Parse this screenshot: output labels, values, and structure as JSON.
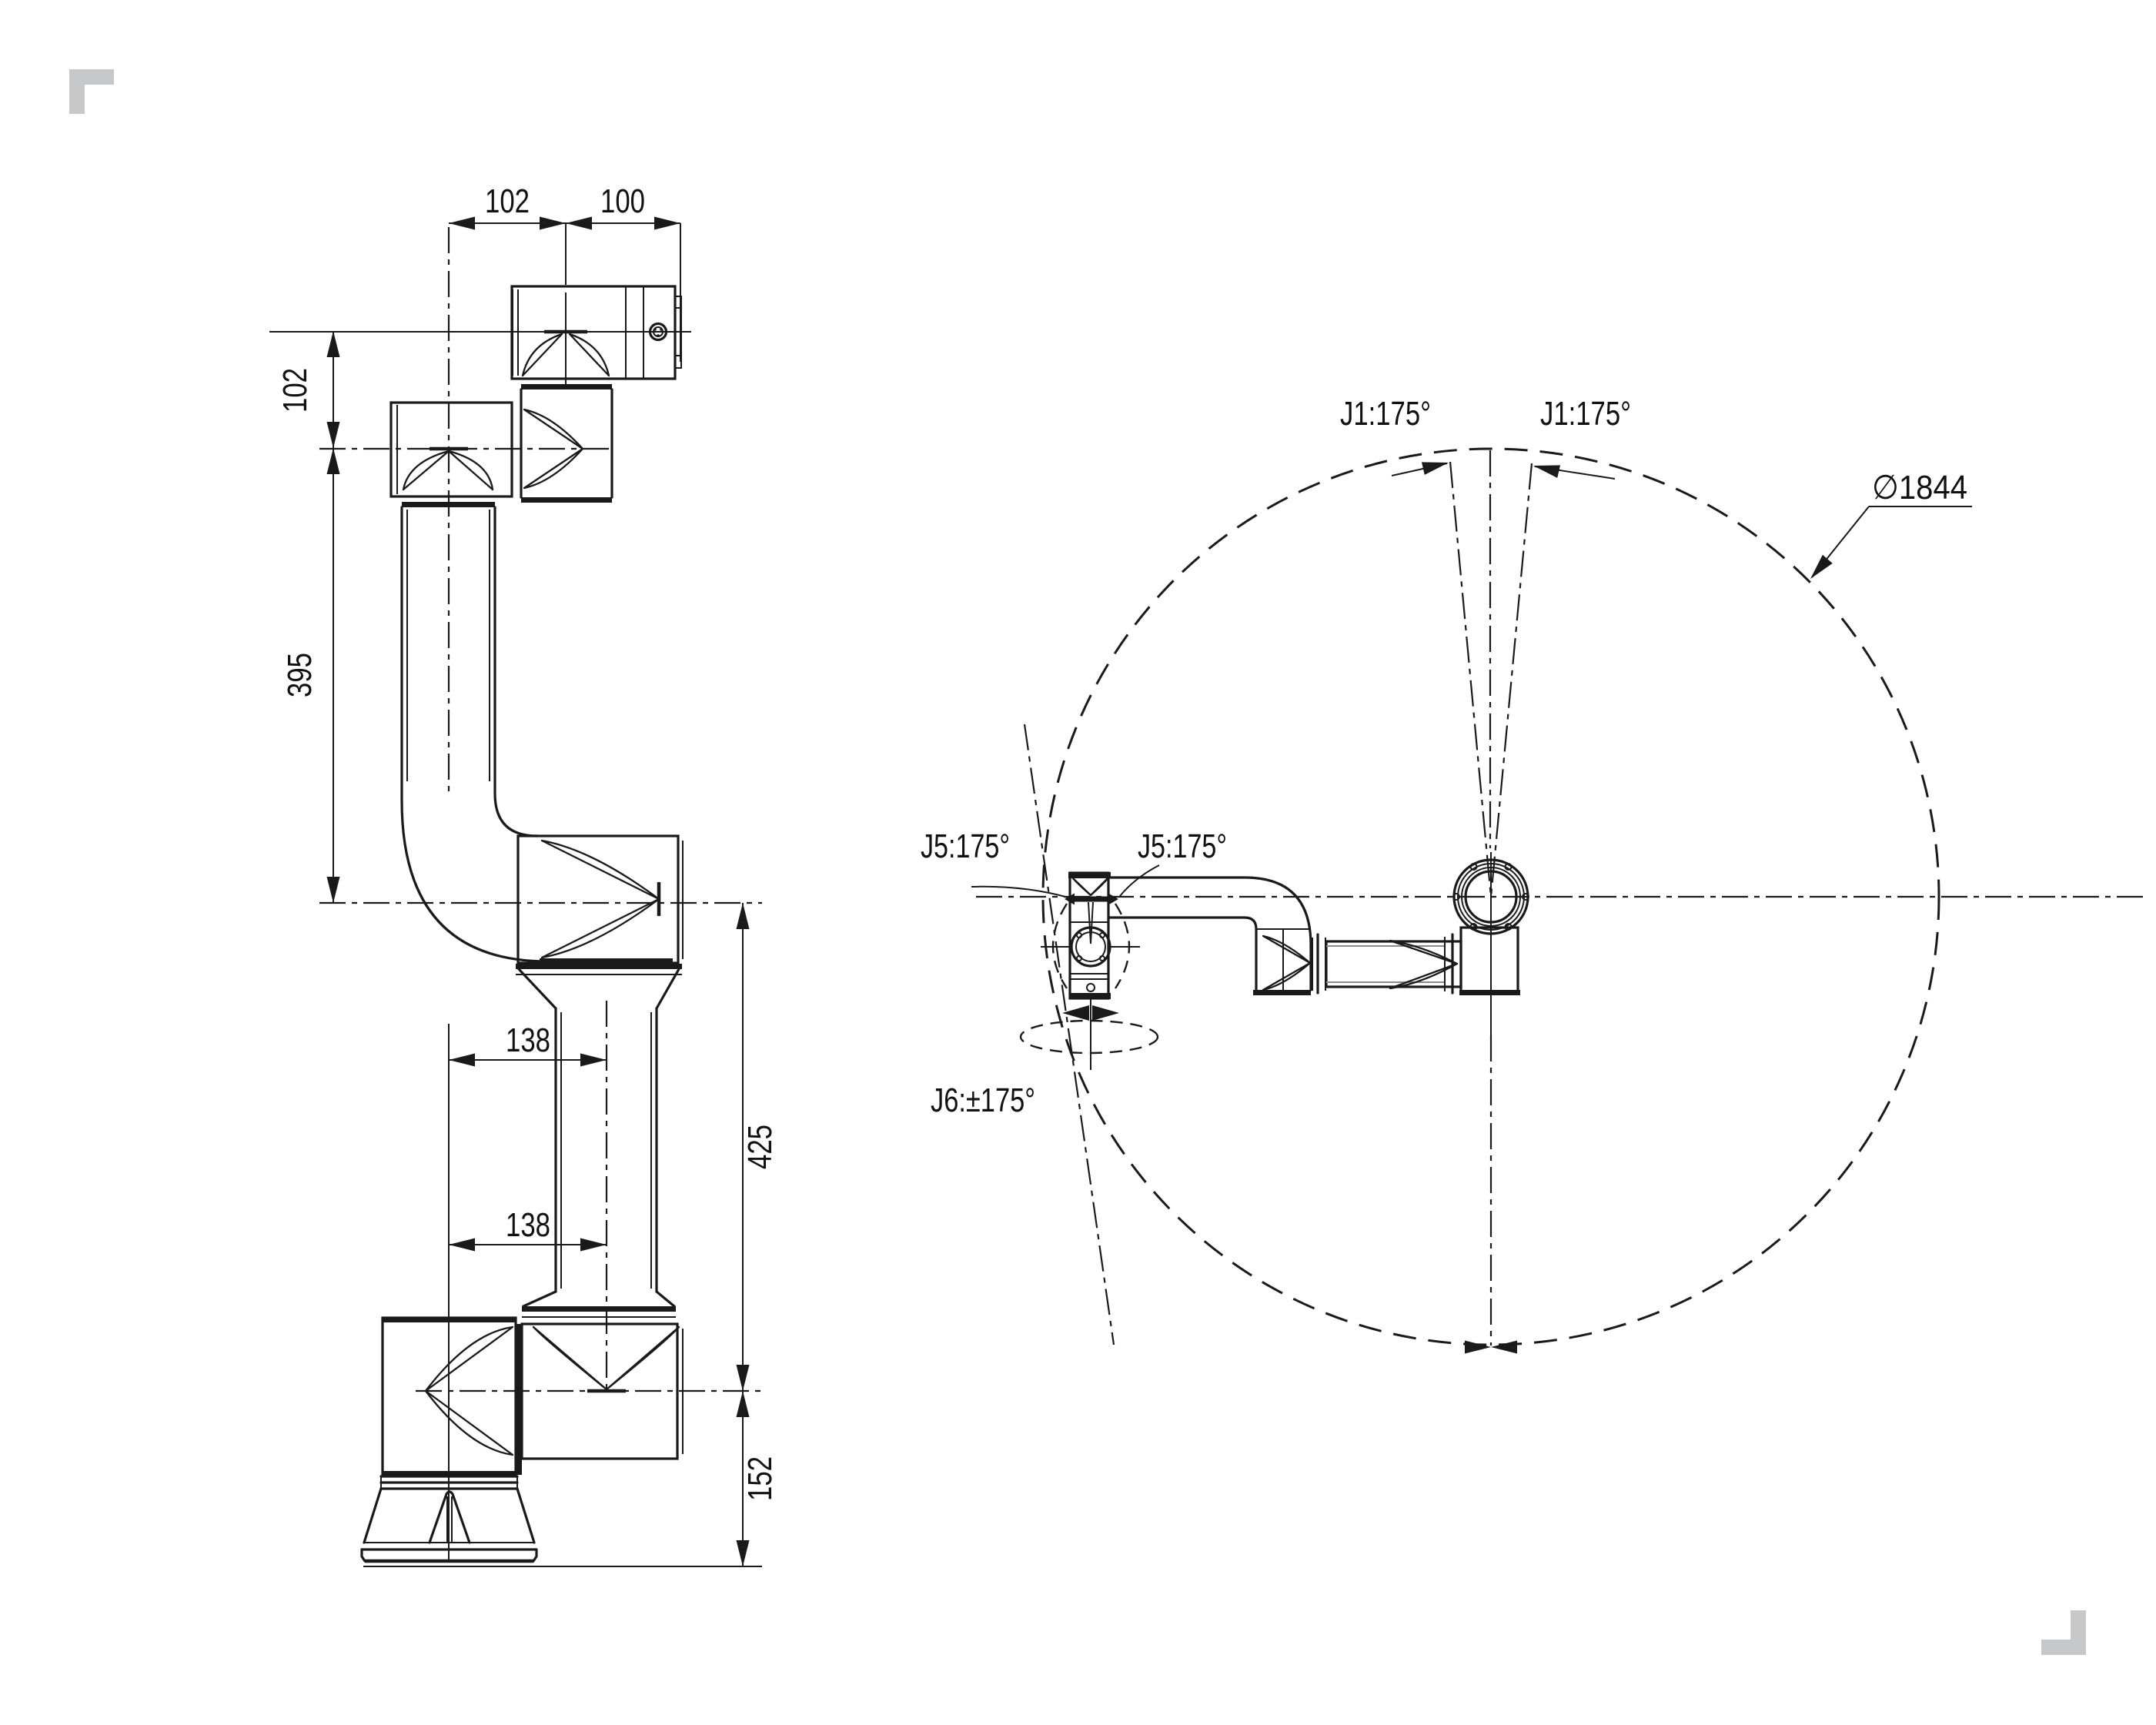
{
  "colors": {
    "background": "#ffffff",
    "line": "#1a1a1a",
    "text": "#111111",
    "corner_mark": "#c6c8ca"
  },
  "side_view": {
    "description": "robot arm side elevation with dimensions (mm)",
    "dims": {
      "wrist_to_tool_offset_top": "102",
      "tool_flange_length": "100",
      "tool_to_wrist_drop": "102",
      "upper_arm_length": "395",
      "elbow_offset_upper": "138",
      "forearm_length": "425",
      "elbow_offset_lower": "138",
      "base_height": "152"
    }
  },
  "top_view": {
    "description": "working envelope top view",
    "labels": {
      "j1_range_left": "J1:175°",
      "j1_range_right": "J1:175°",
      "workspace_diameter": "∅1844",
      "j5_range_left": "J5:175°",
      "j5_range_right": "J5:175°",
      "j6_range": "J6:±175°"
    }
  }
}
